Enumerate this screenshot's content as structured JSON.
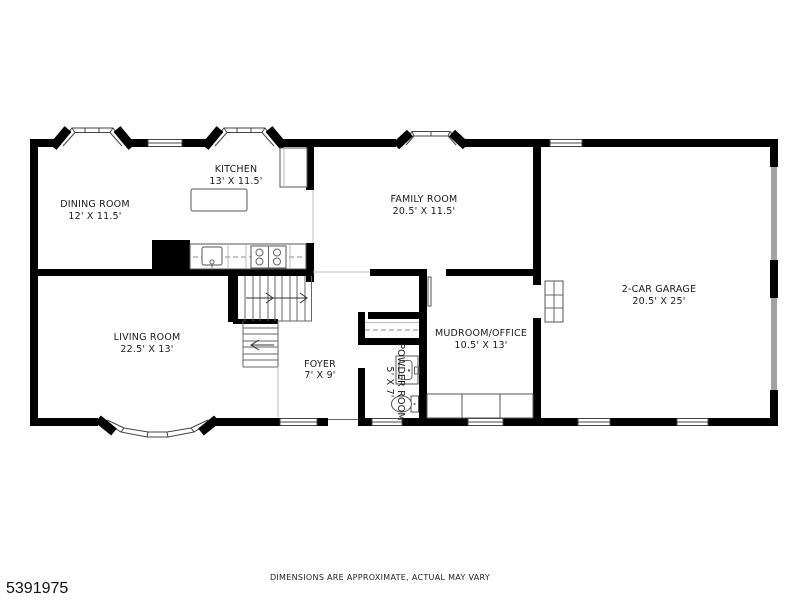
{
  "footer": {
    "mls_number": "5391975",
    "disclaimer": "DIMENSIONS ARE APPROXIMATE, ACTUAL MAY VARY"
  },
  "rooms": {
    "dining": {
      "name": "DINING ROOM",
      "dims": "12' X 11.5'"
    },
    "kitchen": {
      "name": "KITCHEN",
      "dims": "13' X 11.5'"
    },
    "family": {
      "name": "FAMILY ROOM",
      "dims": "20.5' X 11.5'"
    },
    "living": {
      "name": "LIVING ROOM",
      "dims": "22.5' X 13'"
    },
    "foyer": {
      "name": "FOYER",
      "dims": "7' X 9'"
    },
    "powder": {
      "name": "POWDER ROOM",
      "dims": "5' X 7'"
    },
    "mudroom": {
      "name": "MUDROOM/OFFICE",
      "dims": "10.5' X 13'"
    },
    "garage": {
      "name": "2-CAR GARAGE",
      "dims": "20.5' X 25'"
    }
  },
  "colors": {
    "wall": "#000000",
    "window_frame": "#444444",
    "fixture_line": "#555555",
    "garage_door": "#a3a3a3",
    "text": "#1a1a1a",
    "background": "#ffffff"
  }
}
